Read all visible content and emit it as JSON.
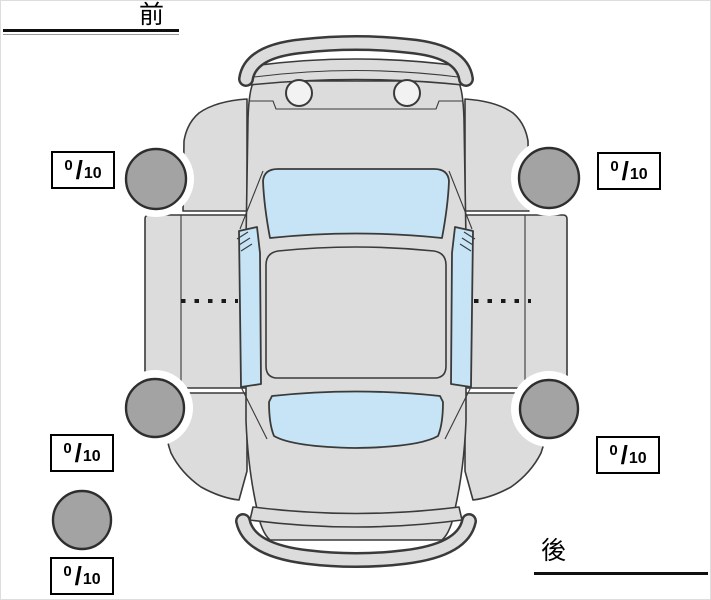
{
  "labels": {
    "front": "前",
    "rear": "後"
  },
  "scores": {
    "separator": "/",
    "front_left": {
      "value": "0",
      "max": "10"
    },
    "front_right": {
      "value": "0",
      "max": "10"
    },
    "rear_left": {
      "value": "0",
      "max": "10"
    },
    "rear_right": {
      "value": "0",
      "max": "10"
    },
    "spare": {
      "value": "0",
      "max": "10"
    }
  },
  "colors": {
    "page_background": "#ffffff",
    "page_border": "#dddddd",
    "body": "#dcdcdc",
    "outline": "#3a3a3a",
    "tire": "#a3a3a3",
    "tire_outline": "#2e2e2e",
    "window": "#c6e4f5",
    "label_text": "#000000",
    "box_border": "#000000",
    "box_background": "#ffffff"
  }
}
